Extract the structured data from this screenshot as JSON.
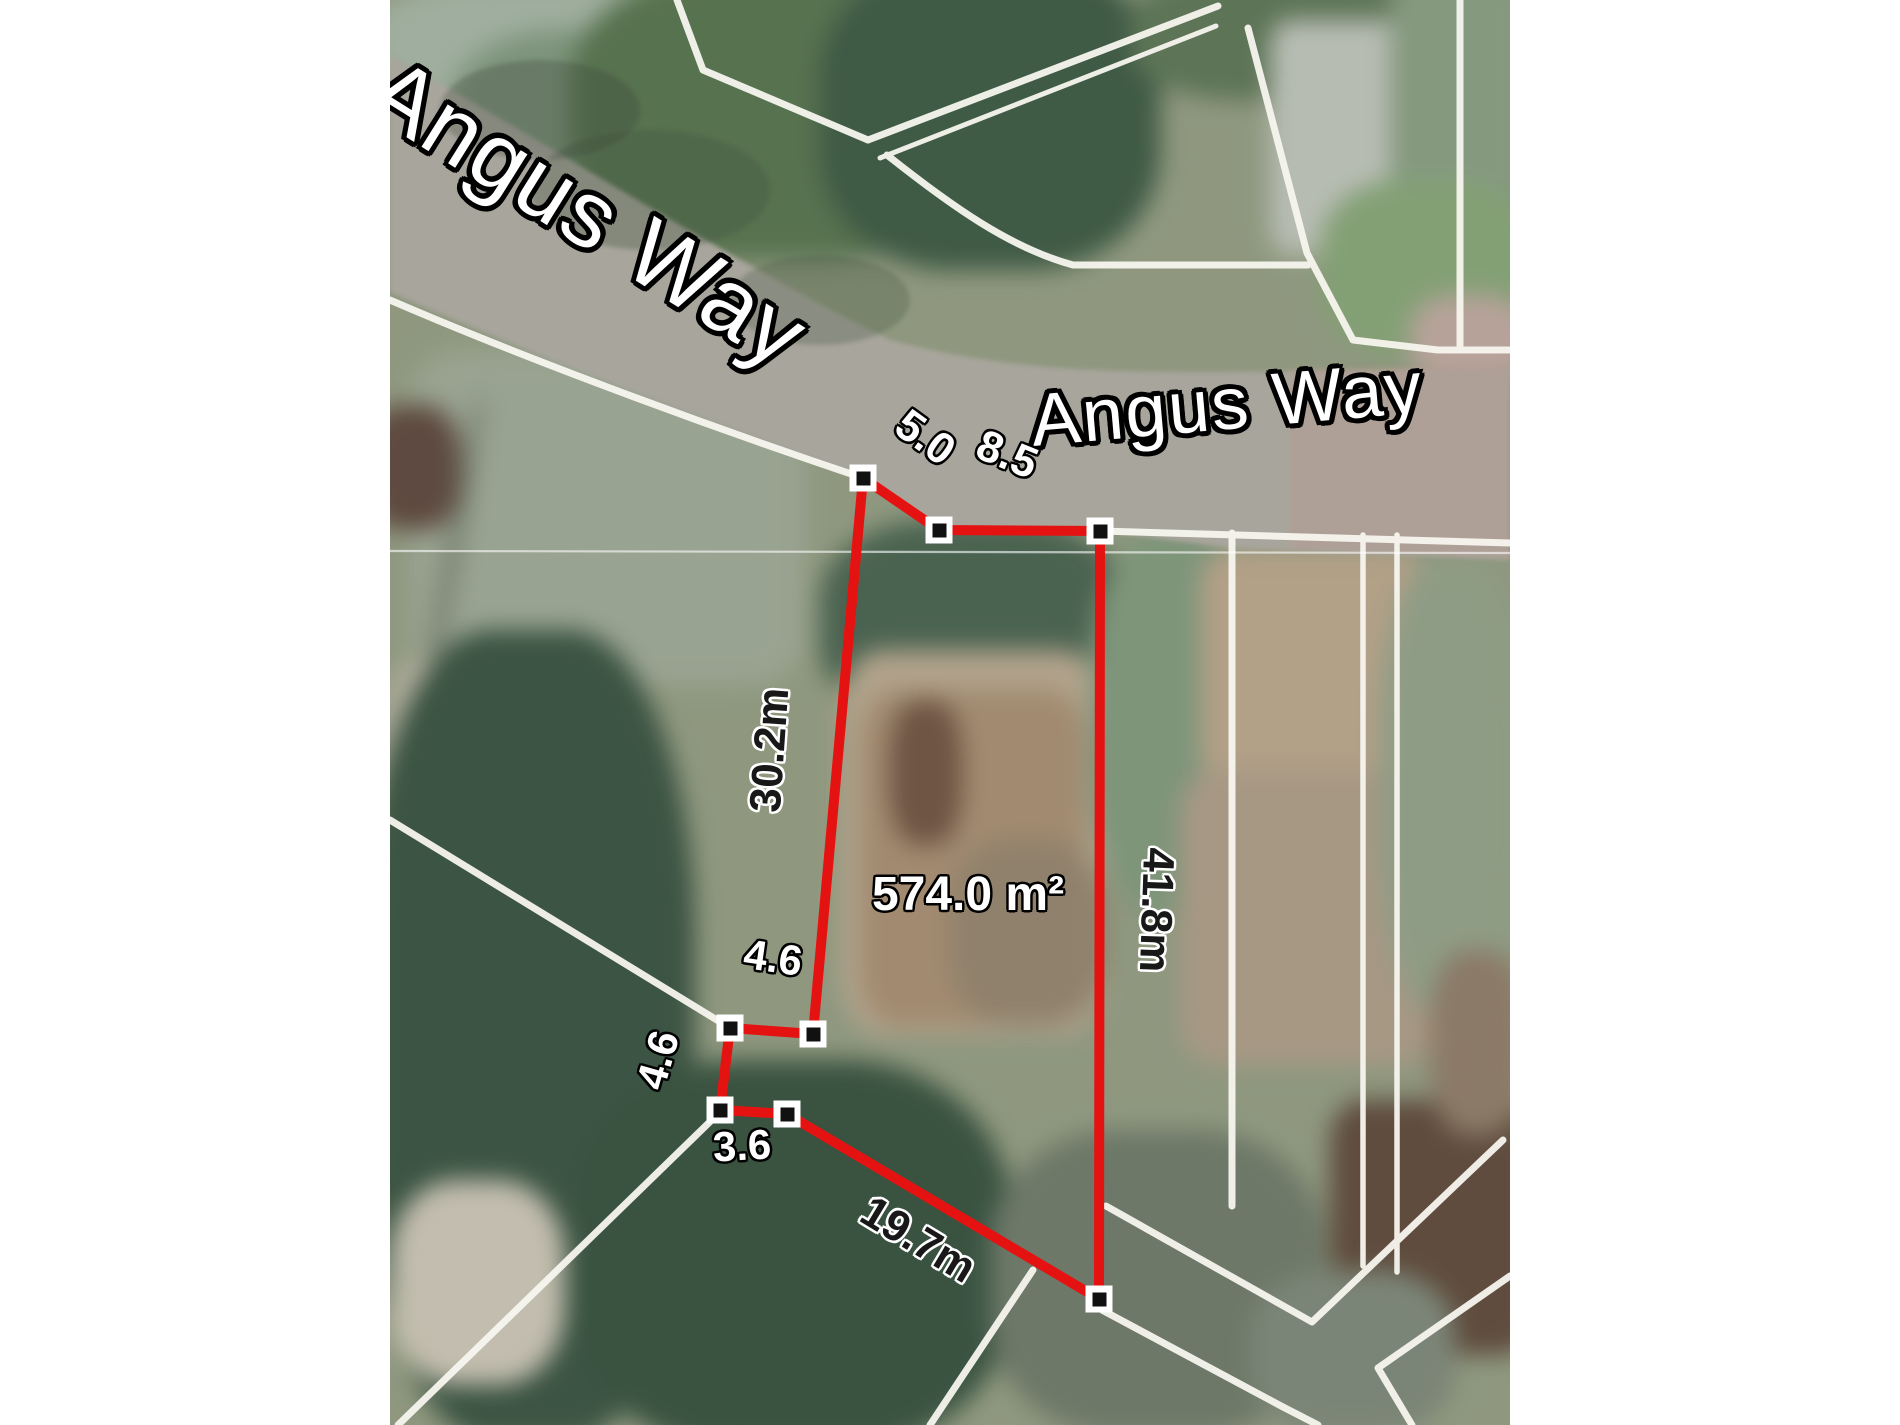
{
  "image_type": "aerial-cadastral-lot-map",
  "map": {
    "street_labels": [
      {
        "text": "Angus Way",
        "x": 198,
        "y": 213,
        "rotate": 32,
        "font_size": 94
      },
      {
        "text": "Angus Way",
        "x": 837,
        "y": 404,
        "rotate": -5,
        "font_size": 74
      }
    ],
    "area_label": {
      "text": "574.0 m²",
      "x": 578,
      "y": 895,
      "rotate": 0,
      "font_size": 48
    },
    "measurements": [
      {
        "text": "5.0",
        "x": 535,
        "y": 438,
        "rotate": 36,
        "style": "light",
        "font_size": 44
      },
      {
        "text": "8.5",
        "x": 617,
        "y": 455,
        "rotate": 22,
        "style": "light",
        "font_size": 44
      },
      {
        "text": "30.2m",
        "x": 380,
        "y": 750,
        "rotate": -86,
        "style": "dark",
        "font_size": 44
      },
      {
        "text": "41.8m",
        "x": 766,
        "y": 910,
        "rotate": 92,
        "style": "dark",
        "font_size": 44
      },
      {
        "text": "4.6",
        "x": 383,
        "y": 958,
        "rotate": 8,
        "style": "light",
        "font_size": 42
      },
      {
        "text": "4.6",
        "x": 268,
        "y": 1060,
        "rotate": -74,
        "style": "light",
        "font_size": 42
      },
      {
        "text": "3.6",
        "x": 352,
        "y": 1146,
        "rotate": -3,
        "style": "light",
        "font_size": 42
      },
      {
        "text": "19.7m",
        "x": 528,
        "y": 1240,
        "rotate": 31,
        "style": "dark",
        "font_size": 44
      }
    ],
    "parcel": {
      "stroke_color": "#e41312",
      "vertices": [
        [
          473,
          478
        ],
        [
          549,
          530
        ],
        [
          710,
          531
        ],
        [
          709,
          1299
        ],
        [
          397,
          1114
        ],
        [
          330,
          1110
        ],
        [
          340,
          1028
        ],
        [
          423,
          1034
        ]
      ]
    },
    "marker": {
      "outer_color": "#ffffff",
      "inner_color": "#111111"
    },
    "cadastral_line_color": "#f7f6ef",
    "road_color": "#a8a59c"
  }
}
